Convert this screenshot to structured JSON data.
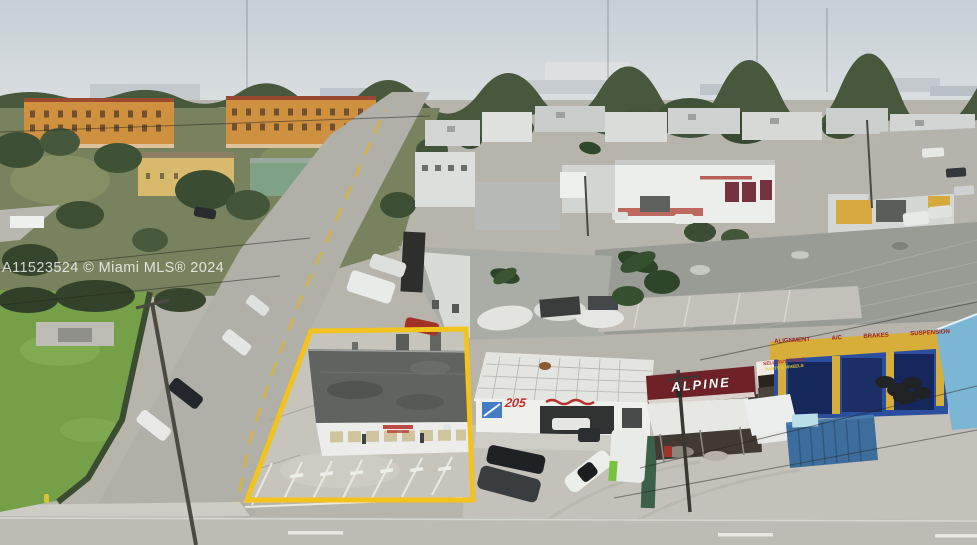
{
  "photo": {
    "description": "Aerial drone photo of a single-story commercial property outlined in yellow, with adjacent auto shops, industrial warehouses, apartment buildings and streets",
    "highlight_color": "#F2C21D"
  },
  "watermark": {
    "text": "A11523524 © Miami MLS® 2024"
  },
  "signs": {
    "unit_number": "205",
    "alpine": "ALPINE",
    "sell_buy_trade": "SELL-BUY-TRADE",
    "parts_wheels": "PARTS & WHEELS",
    "alignment": "ALIGNMENT",
    "ac": "A/C",
    "brakes": "BRAKES",
    "suspension": "SUSPENSION"
  },
  "colors": {
    "sky_top": "#c6cfd4",
    "sky_bottom": "#dadfe1",
    "treeline": "#47583d",
    "grass": "#75a047",
    "concrete": "#c3c1b9",
    "street": "#b0afa8",
    "subject_roof": "#606360",
    "outline_yellow": "#F2C21D",
    "alpine_maroon": "#6e2228",
    "shop_blue": "#2a4f9e",
    "light_blue_wall": "#7cb6d5",
    "apartment_orange": "#cf9140",
    "apartment_roof": "#9a4a31",
    "container_blue": "#3d6d9c",
    "service_yellow": "#d6ae39"
  }
}
